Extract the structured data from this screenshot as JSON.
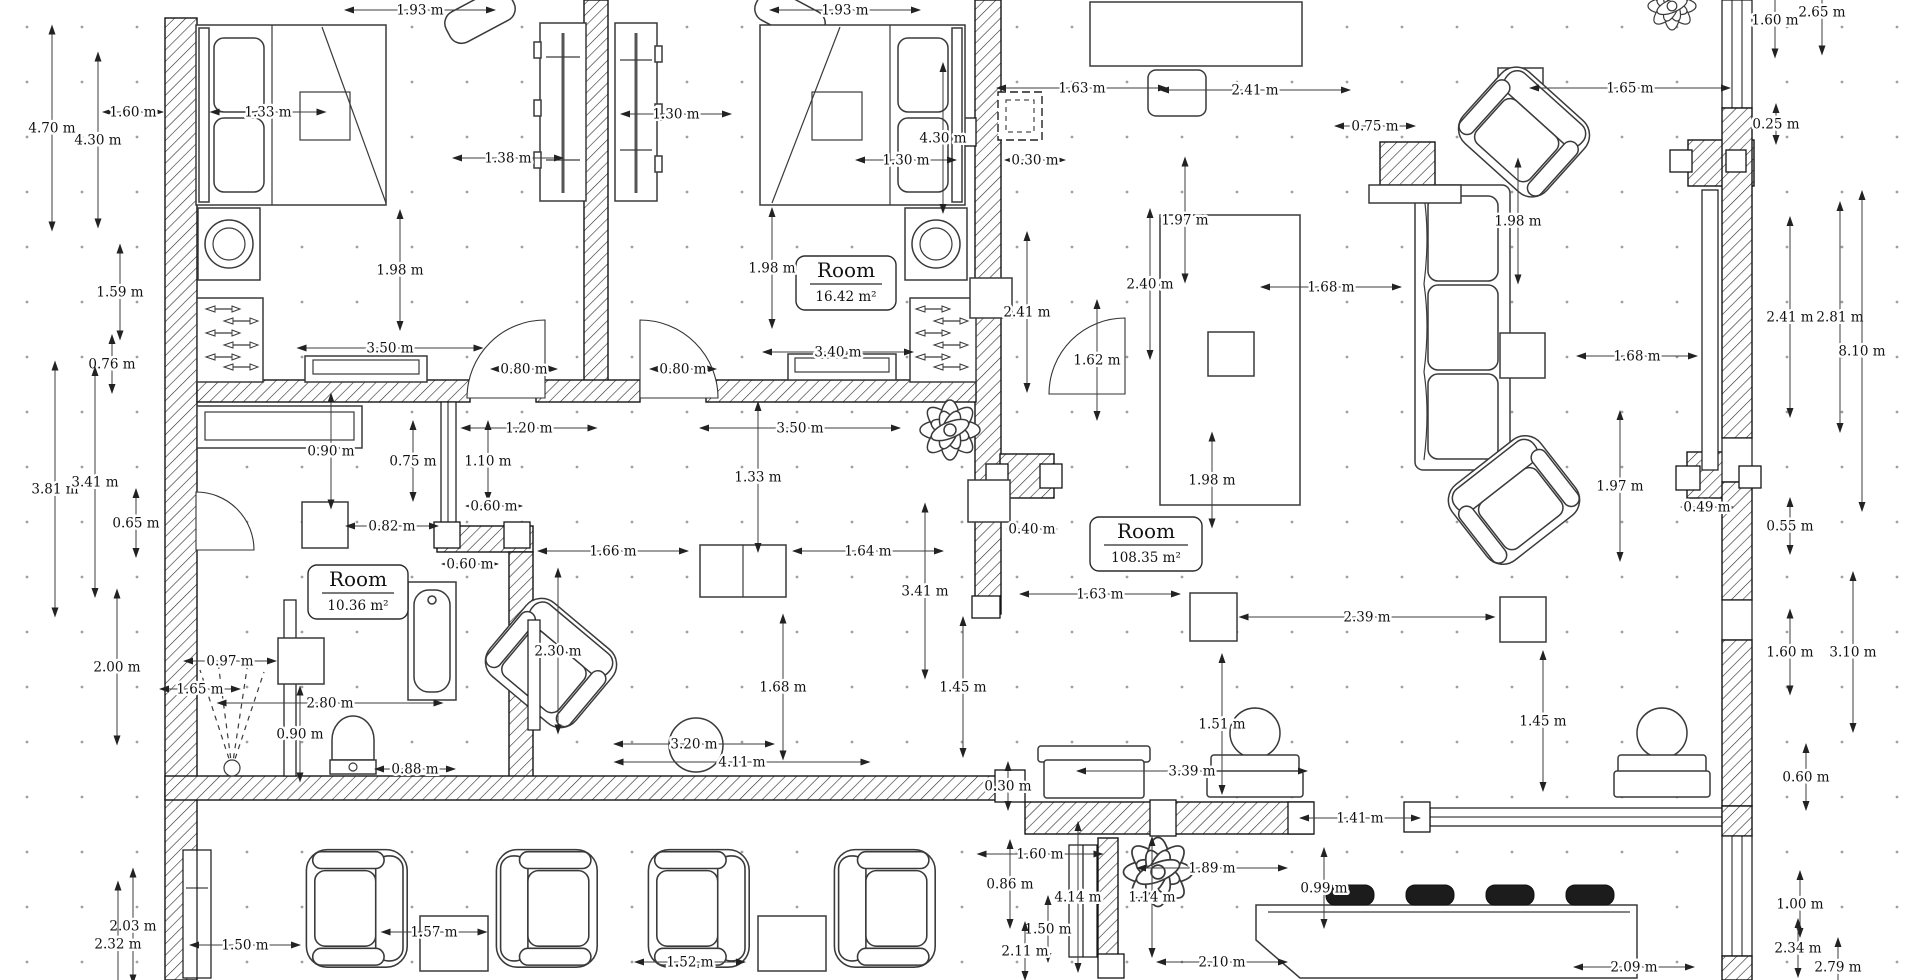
{
  "drawing": {
    "type": "architectural-floor-plan",
    "units": "m",
    "background_color": "#ffffff",
    "line_color": "#141414",
    "grid_dot_color": "#a0a0a0"
  },
  "rooms": [
    {
      "name": "Room",
      "area": "16.42 m²"
    },
    {
      "name": "Room",
      "area": "108.35 m²"
    },
    {
      "name": "Room",
      "area": "10.36 m²"
    }
  ],
  "dimensions": [
    {
      "label": "1.93 m",
      "x": 420,
      "y": 10,
      "dir": "h",
      "len": 150
    },
    {
      "label": "1.93 m",
      "x": 845,
      "y": 10,
      "dir": "h",
      "len": 150
    },
    {
      "label": "4.70 m",
      "x": 52,
      "y": 128,
      "dir": "v",
      "len": 205
    },
    {
      "label": "4.30 m",
      "x": 98,
      "y": 140,
      "dir": "v",
      "len": 175
    },
    {
      "label": "1.60 m",
      "x": 133,
      "y": 112,
      "dir": "h",
      "len": 60
    },
    {
      "label": "1.33 m",
      "x": 268,
      "y": 112,
      "dir": "h",
      "len": 115
    },
    {
      "label": "1.38 m",
      "x": 508,
      "y": 158,
      "dir": "h",
      "len": 110
    },
    {
      "label": "1.30 m",
      "x": 676,
      "y": 114,
      "dir": "h",
      "len": 110
    },
    {
      "label": "1.30 m",
      "x": 906,
      "y": 160,
      "dir": "h",
      "len": 100
    },
    {
      "label": "4.30 m",
      "x": 943,
      "y": 138,
      "dir": "v",
      "len": 150
    },
    {
      "label": "1.59 m",
      "x": 120,
      "y": 292,
      "dir": "v",
      "len": 95
    },
    {
      "label": "1.98 m",
      "x": 400,
      "y": 270,
      "dir": "v",
      "len": 120
    },
    {
      "label": "1.98 m",
      "x": 772,
      "y": 268,
      "dir": "v",
      "len": 120
    },
    {
      "label": "3.50 m",
      "x": 390,
      "y": 348,
      "dir": "h",
      "len": 185
    },
    {
      "label": "3.40 m",
      "x": 838,
      "y": 352,
      "dir": "h",
      "len": 150
    },
    {
      "label": "0.80 m",
      "x": 524,
      "y": 369,
      "dir": "h",
      "len": 66
    },
    {
      "label": "0.80 m",
      "x": 683,
      "y": 369,
      "dir": "h",
      "len": 66
    },
    {
      "label": "1.63 m",
      "x": 1082,
      "y": 88,
      "dir": "h",
      "len": 170
    },
    {
      "label": "2.41 m",
      "x": 1255,
      "y": 90,
      "dir": "h",
      "len": 190
    },
    {
      "label": "1.65 m",
      "x": 1630,
      "y": 88,
      "dir": "h",
      "len": 200
    },
    {
      "label": "0.75 m",
      "x": 1375,
      "y": 126,
      "dir": "h",
      "len": 80
    },
    {
      "label": "0.30 m",
      "x": 1035,
      "y": 160,
      "dir": "h",
      "len": 60
    },
    {
      "label": "1.60 m",
      "x": 1775,
      "y": 20,
      "dir": "v",
      "len": 75
    },
    {
      "label": "2.65 m",
      "x": 1822,
      "y": 12,
      "dir": "v",
      "len": 85
    },
    {
      "label": "0.25 m",
      "x": 1776,
      "y": 124,
      "dir": "v",
      "len": 40
    },
    {
      "label": "1.97 m",
      "x": 1185,
      "y": 220,
      "dir": "v",
      "len": 125
    },
    {
      "label": "1.98 m",
      "x": 1518,
      "y": 221,
      "dir": "v",
      "len": 125
    },
    {
      "label": "2.41 m",
      "x": 1027,
      "y": 312,
      "dir": "v",
      "len": 160
    },
    {
      "label": "1.62 m",
      "x": 1097,
      "y": 360,
      "dir": "v",
      "len": 120
    },
    {
      "label": "2.40 m",
      "x": 1150,
      "y": 284,
      "dir": "v",
      "len": 150
    },
    {
      "label": "1.68 m",
      "x": 1331,
      "y": 287,
      "dir": "h",
      "len": 140
    },
    {
      "label": "1.98 m",
      "x": 1212,
      "y": 480,
      "dir": "v",
      "len": 95
    },
    {
      "label": "2.41 m",
      "x": 1790,
      "y": 317,
      "dir": "v",
      "len": 200
    },
    {
      "label": "2.81 m",
      "x": 1840,
      "y": 317,
      "dir": "v",
      "len": 230
    },
    {
      "label": "8.10 m",
      "x": 1862,
      "y": 351,
      "dir": "v",
      "len": 320
    },
    {
      "label": "1.68 m",
      "x": 1637,
      "y": 356,
      "dir": "h",
      "len": 120
    },
    {
      "label": "0.76 m",
      "x": 112,
      "y": 364,
      "dir": "v",
      "len": 58
    },
    {
      "label": "0.90 m",
      "x": 331,
      "y": 451,
      "dir": "v",
      "len": 115
    },
    {
      "label": "1.20 m",
      "x": 529,
      "y": 428,
      "dir": "h",
      "len": 135
    },
    {
      "label": "3.50 m",
      "x": 800,
      "y": 428,
      "dir": "h",
      "len": 200
    },
    {
      "label": "0.75 m",
      "x": 413,
      "y": 461,
      "dir": "v",
      "len": 80
    },
    {
      "label": "1.10 m",
      "x": 488,
      "y": 461,
      "dir": "v",
      "len": 80
    },
    {
      "label": "1.33 m",
      "x": 758,
      "y": 477,
      "dir": "v",
      "len": 150
    },
    {
      "label": "0.60 m",
      "x": 494,
      "y": 506,
      "dir": "h",
      "len": 56
    },
    {
      "label": "0.82 m",
      "x": 392,
      "y": 526,
      "dir": "h",
      "len": 92
    },
    {
      "label": "0.60 m",
      "x": 470,
      "y": 564,
      "dir": "h",
      "len": 56
    },
    {
      "label": "0.40 m",
      "x": 1032,
      "y": 529,
      "dir": "h",
      "len": 50
    },
    {
      "label": "0.65 m",
      "x": 136,
      "y": 523,
      "dir": "v",
      "len": 68
    },
    {
      "label": "3.81 m",
      "x": 55,
      "y": 489,
      "dir": "v",
      "len": 255
    },
    {
      "label": "3.41 m",
      "x": 95,
      "y": 482,
      "dir": "v",
      "len": 230
    },
    {
      "label": "2.00 m",
      "x": 117,
      "y": 667,
      "dir": "v",
      "len": 155
    },
    {
      "label": "0.97 m",
      "x": 230,
      "y": 661,
      "dir": "h",
      "len": 92
    },
    {
      "label": "1.65 m",
      "x": 200,
      "y": 689,
      "dir": "h",
      "len": 80
    },
    {
      "label": "2.80 m",
      "x": 330,
      "y": 703,
      "dir": "h",
      "len": 225
    },
    {
      "label": "0.90 m",
      "x": 300,
      "y": 734,
      "dir": "v",
      "len": 95
    },
    {
      "label": "0.88 m",
      "x": 415,
      "y": 769,
      "dir": "h",
      "len": 80
    },
    {
      "label": "2.30 m",
      "x": 558,
      "y": 651,
      "dir": "v",
      "len": 165
    },
    {
      "label": "1.66 m",
      "x": 613,
      "y": 551,
      "dir": "h",
      "len": 150
    },
    {
      "label": "1.64 m",
      "x": 868,
      "y": 551,
      "dir": "h",
      "len": 150
    },
    {
      "label": "3.41 m",
      "x": 925,
      "y": 591,
      "dir": "v",
      "len": 175
    },
    {
      "label": "1.68 m",
      "x": 783,
      "y": 687,
      "dir": "v",
      "len": 145
    },
    {
      "label": "1.45 m",
      "x": 963,
      "y": 687,
      "dir": "v",
      "len": 140
    },
    {
      "label": "3.20 m",
      "x": 694,
      "y": 744,
      "dir": "h",
      "len": 160
    },
    {
      "label": "4.11 m",
      "x": 742,
      "y": 762,
      "dir": "h",
      "len": 255
    },
    {
      "label": "1.63 m",
      "x": 1100,
      "y": 594,
      "dir": "h",
      "len": 160
    },
    {
      "label": "2.39 m",
      "x": 1367,
      "y": 617,
      "dir": "h",
      "len": 255
    },
    {
      "label": "1.51 m",
      "x": 1222,
      "y": 724,
      "dir": "v",
      "len": 140
    },
    {
      "label": "1.45 m",
      "x": 1543,
      "y": 721,
      "dir": "v",
      "len": 140
    },
    {
      "label": "3.39 m",
      "x": 1192,
      "y": 771,
      "dir": "h",
      "len": 230
    },
    {
      "label": "0.30 m",
      "x": 1008,
      "y": 786,
      "dir": "v",
      "len": 48
    },
    {
      "label": "1.41 m",
      "x": 1360,
      "y": 818,
      "dir": "h",
      "len": 120
    },
    {
      "label": "1.97 m",
      "x": 1620,
      "y": 486,
      "dir": "v",
      "len": 150
    },
    {
      "label": "0.49 m",
      "x": 1707,
      "y": 507,
      "dir": "h",
      "len": 52
    },
    {
      "label": "0.55 m",
      "x": 1790,
      "y": 526,
      "dir": "v",
      "len": 56
    },
    {
      "label": "1.60 m",
      "x": 1790,
      "y": 652,
      "dir": "v",
      "len": 85
    },
    {
      "label": "3.10 m",
      "x": 1853,
      "y": 652,
      "dir": "v",
      "len": 160
    },
    {
      "label": "0.60 m",
      "x": 1806,
      "y": 777,
      "dir": "v",
      "len": 66
    },
    {
      "label": "2.03 m",
      "x": 133,
      "y": 926,
      "dir": "v",
      "len": 115
    },
    {
      "label": "2.32 m",
      "x": 118,
      "y": 944,
      "dir": "v",
      "len": 125
    },
    {
      "label": "1.50 m",
      "x": 245,
      "y": 945,
      "dir": "h",
      "len": 110
    },
    {
      "label": "1.57 m",
      "x": 434,
      "y": 932,
      "dir": "h",
      "len": 105
    },
    {
      "label": "1.52 m",
      "x": 690,
      "y": 962,
      "dir": "h",
      "len": 110
    },
    {
      "label": "1.60 m",
      "x": 1040,
      "y": 854,
      "dir": "h",
      "len": 125
    },
    {
      "label": "0.86 m",
      "x": 1010,
      "y": 884,
      "dir": "v",
      "len": 88
    },
    {
      "label": "4.14 m",
      "x": 1078,
      "y": 897,
      "dir": "v",
      "len": 150
    },
    {
      "label": "1.14 m",
      "x": 1152,
      "y": 897,
      "dir": "v",
      "len": 120
    },
    {
      "label": "1.89 m",
      "x": 1212,
      "y": 868,
      "dir": "h",
      "len": 150
    },
    {
      "label": "1.50 m",
      "x": 1048,
      "y": 929,
      "dir": "v",
      "len": 66
    },
    {
      "label": "2.11 m",
      "x": 1025,
      "y": 951,
      "dir": "v",
      "len": 58
    },
    {
      "label": "2.10 m",
      "x": 1222,
      "y": 962,
      "dir": "h",
      "len": 130
    },
    {
      "label": "0.99 m",
      "x": 1324,
      "y": 888,
      "dir": "v",
      "len": 80
    },
    {
      "label": "2.09 m",
      "x": 1634,
      "y": 967,
      "dir": "h",
      "len": 120
    },
    {
      "label": "1.00 m",
      "x": 1800,
      "y": 904,
      "dir": "v",
      "len": 66
    },
    {
      "label": "2.34 m",
      "x": 1798,
      "y": 948,
      "dir": "v",
      "len": 58
    },
    {
      "label": "2.79 m",
      "x": 1838,
      "y": 967,
      "dir": "v",
      "len": 58
    }
  ]
}
